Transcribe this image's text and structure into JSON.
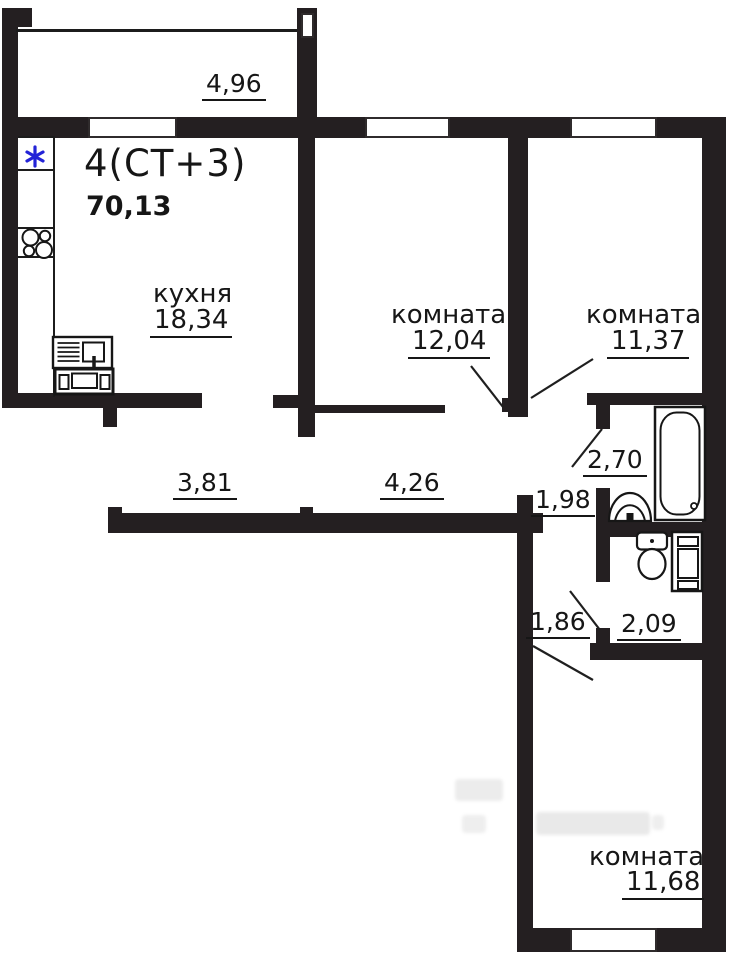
{
  "plan": {
    "title": "4(СТ+3)",
    "total_area": "70,13",
    "balcony": {
      "dim": "4,96"
    },
    "kitchen": {
      "name": "кухня",
      "area": "18,34"
    },
    "room_top_center": {
      "name": "комната",
      "area": "12,04"
    },
    "room_top_right": {
      "name": "комната",
      "area": "11,37"
    },
    "room_bottom": {
      "name": "комната",
      "area": "11,68"
    },
    "hallway": {
      "dim_left": "3,81",
      "dim_right": "4,26"
    },
    "bathroom": {
      "dim": "2,70"
    },
    "bath_corridor": {
      "dim": "1,98"
    },
    "wc_corridor": {
      "dim": "1,86"
    },
    "wc": {
      "dim": "2,09"
    }
  },
  "colors": {
    "walls": "#241f21",
    "text": "#161616",
    "asterisk": "#2323d7",
    "background": "#ffffff"
  },
  "icons": {
    "ventilation_mark": "asterisk-icon",
    "stove": "stove-burners-icon",
    "kitchen_sink": "kitchen-sink-icon",
    "cooker": "cooker-icon",
    "bathtub": "bathtub-icon",
    "washbasin": "washbasin-icon",
    "toilet": "toilet-icon",
    "washing_machine": "washing-machine-icon"
  }
}
